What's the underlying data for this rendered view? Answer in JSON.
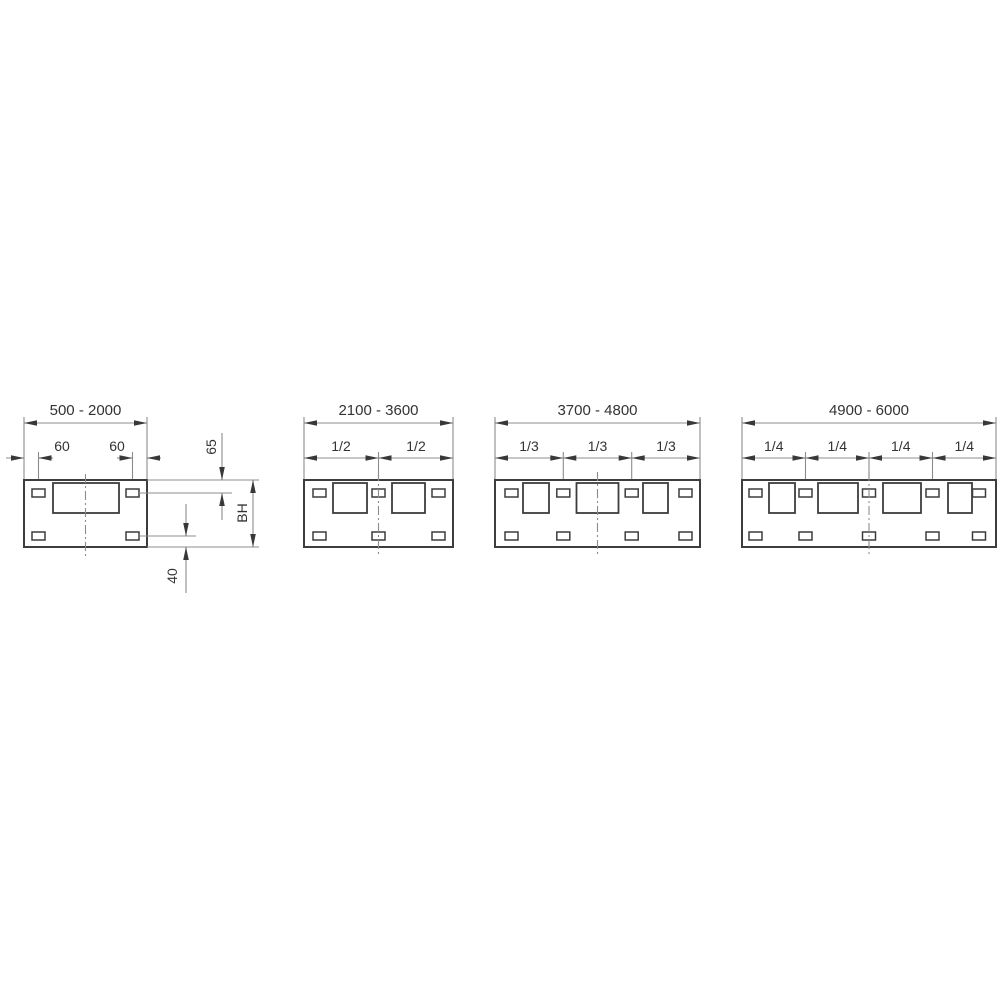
{
  "diagram": {
    "colors": {
      "background": "#ffffff",
      "outline": "#3d3d3d",
      "dimension_lines": "#8c8c8c",
      "text": "#333333"
    },
    "drawings": [
      {
        "range_label": "500 - 2000",
        "sub_labels": [
          "60",
          "60"
        ],
        "side_dims": {
          "top_offset_label": "65",
          "body_height_label": "BH",
          "bottom_offset_label": "40"
        }
      },
      {
        "range_label": "2100 - 3600",
        "sub_labels": [
          "1/2",
          "1/2"
        ]
      },
      {
        "range_label": "3700 - 4800",
        "sub_labels": [
          "1/3",
          "1/3",
          "1/3"
        ]
      },
      {
        "range_label": "4900 - 6000",
        "sub_labels": [
          "1/4",
          "1/4",
          "1/4",
          "1/4"
        ]
      }
    ]
  }
}
